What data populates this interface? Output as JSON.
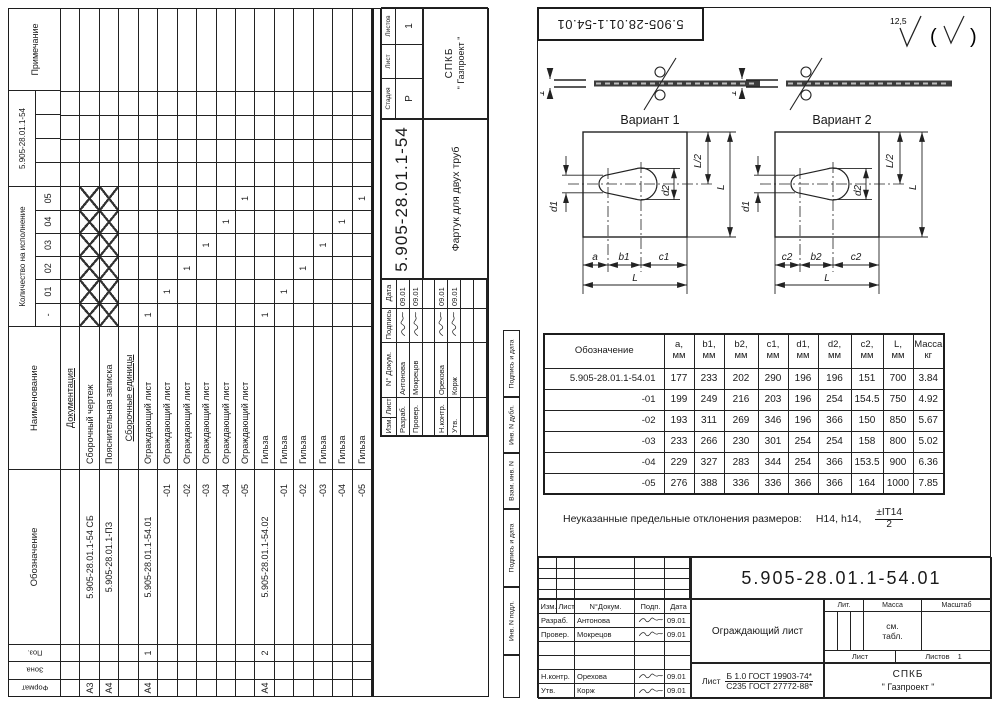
{
  "left_sheet": {
    "cols": {
      "format": "Формат",
      "zone": "Зона",
      "pos": "Поз.",
      "designation": "Обозначение",
      "name": "Наименование",
      "note": "Примечание"
    },
    "qty_group_label": "Количество на исполнение",
    "qty_group_doc": "5.905-28.01.1-54",
    "qty_cols": [
      "-",
      "01",
      "02",
      "03",
      "04",
      "05"
    ],
    "rows": [
      {
        "name": "Документация",
        "u": 1
      },
      {
        "format": "А3",
        "designation": "5.905-28.01.1-54 СБ",
        "name": "Сборочный чертеж",
        "qty": [
          "x",
          "x",
          "x",
          "x",
          "x",
          "x"
        ]
      },
      {
        "format": "А4",
        "designation": "5.905-28.01.1-ПЗ",
        "name": "Пояснительная записка",
        "qty": [
          "x",
          "x",
          "x",
          "x",
          "x",
          "x"
        ]
      },
      {
        "name": "Сборочные единицы",
        "u": 1
      },
      {
        "format": "А4",
        "pos": "1",
        "designation": "5.905-28.01.1-54.01",
        "name": "Ограждающий лист",
        "qty": [
          "1",
          "",
          "",
          "",
          "",
          ""
        ]
      },
      {
        "designation": "-01",
        "name": "Ограждающий лист",
        "qty": [
          "",
          "1",
          "",
          "",
          "",
          ""
        ]
      },
      {
        "designation": "-02",
        "name": "Ограждающий лист",
        "qty": [
          "",
          "",
          "1",
          "",
          "",
          ""
        ]
      },
      {
        "designation": "-03",
        "name": "Ограждающий лист",
        "qty": [
          "",
          "",
          "",
          "1",
          "",
          ""
        ]
      },
      {
        "designation": "-04",
        "name": "Ограждающий лист",
        "qty": [
          "",
          "",
          "",
          "",
          "1",
          ""
        ]
      },
      {
        "designation": "-05",
        "name": "Ограждающий лист",
        "qty": [
          "",
          "",
          "",
          "",
          "",
          "1"
        ]
      },
      {
        "format": "А4",
        "pos": "2",
        "designation": "5.905-28.01.1-54.02",
        "name": "Гильза",
        "qty": [
          "1",
          "",
          "",
          "",
          "",
          ""
        ]
      },
      {
        "designation": "-01",
        "name": "Гильза",
        "qty": [
          "",
          "1",
          "",
          "",
          "",
          ""
        ]
      },
      {
        "designation": "-02",
        "name": "Гильза",
        "qty": [
          "",
          "",
          "1",
          "",
          "",
          ""
        ]
      },
      {
        "designation": "-03",
        "name": "Гильза",
        "qty": [
          "",
          "",
          "",
          "1",
          "",
          ""
        ]
      },
      {
        "designation": "-04",
        "name": "Гильза",
        "qty": [
          "",
          "",
          "",
          "",
          "1",
          ""
        ]
      },
      {
        "designation": "-05",
        "name": "Гильза",
        "qty": [
          "",
          "",
          "",
          "",
          "",
          "1"
        ]
      }
    ],
    "stamp": {
      "doc_number": "5.905-28.01.1-54",
      "title": "Фартук для двух труб",
      "stage_label": "Стадия",
      "sheet_label": "Лист",
      "sheets_label": "Листов",
      "stage": "Р",
      "sheet": "",
      "sheets": "1",
      "org_line1": "СПКБ",
      "org_line2": "\" Газпроект \"",
      "head": [
        "Изм.",
        "Лист",
        "N° Докум.",
        "Подпись",
        "Дата"
      ],
      "sign_rows": [
        {
          "role": "Разраб.",
          "name": "Антонова",
          "date": "09.01"
        },
        {
          "role": "Провер.",
          "name": "Мокрецов",
          "date": "09.01"
        },
        {
          "role": "",
          "name": "",
          "date": ""
        },
        {
          "role": "Н.контр.",
          "name": "Орехова",
          "date": "09.01"
        },
        {
          "role": "Утв.",
          "name": "Корж",
          "date": "09.01"
        },
        {
          "role": "",
          "name": "",
          "date": ""
        },
        {
          "role": "",
          "name": "",
          "date": ""
        }
      ]
    }
  },
  "right_sheet": {
    "flip_label": "5.905-28.01.1-54.01",
    "roughness": "12,5",
    "variants": [
      {
        "label": "Вариант 1",
        "thickness": "1",
        "dim_bottom": [
          "a",
          "b1",
          "c1"
        ],
        "dim_total": "L",
        "dim_d1": "d1",
        "dim_d2": "d2",
        "dim_half": "L/2",
        "dim_right": "L"
      },
      {
        "label": "Вариант 2",
        "thickness": "1",
        "dim_bottom": [
          "c2",
          "b2",
          "c2"
        ],
        "dim_total": "L",
        "dim_d1": "d1",
        "dim_d2": "d2",
        "dim_half": "L/2",
        "dim_right": "L"
      }
    ],
    "dims_table": {
      "headers": [
        "Обозначение",
        "a,\nмм",
        "b1,\nмм",
        "b2,\nмм",
        "c1,\nмм",
        "d1,\nмм",
        "d2,\nмм",
        "c2,\nмм",
        "L,\nмм",
        "Масса\nкг"
      ],
      "rows": [
        [
          "5.905-28.01.1-54.01",
          "177",
          "233",
          "202",
          "290",
          "196",
          "196",
          "151",
          "700",
          "3.84"
        ],
        [
          "-01",
          "199",
          "249",
          "216",
          "203",
          "196",
          "254",
          "154.5",
          "750",
          "4.92"
        ],
        [
          "-02",
          "193",
          "311",
          "269",
          "346",
          "196",
          "366",
          "150",
          "850",
          "5.67"
        ],
        [
          "-03",
          "233",
          "266",
          "230",
          "301",
          "254",
          "254",
          "158",
          "800",
          "5.02"
        ],
        [
          "-04",
          "229",
          "327",
          "283",
          "344",
          "254",
          "366",
          "153.5",
          "900",
          "6.36"
        ],
        [
          "-05",
          "276",
          "388",
          "336",
          "336",
          "366",
          "366",
          "164",
          "1000",
          "7.85"
        ]
      ]
    },
    "note_text": "Неуказанные предельные отклонения размеров:",
    "note_tol": "H14, h14,",
    "note_frac_top": "±IT14",
    "note_frac_bottom": "2",
    "side_strip": [
      "Подпись и дата",
      "Инв. N дубл.",
      "Взам. инв. N",
      "Подпись и дата",
      "Инв. N подл."
    ],
    "stamp": {
      "doc_number": "5.905-28.01.1-54.01",
      "title": "Ограждающий лист",
      "material_word": "Лист",
      "material_top": "Б 1.0 ГОСТ 19903-74*",
      "material_bottom": "С235 ГОСТ 27772-88*",
      "lit_label": "Лит.",
      "mass_label": "Масса",
      "scale_label": "Масштаб",
      "mass_value": "см.\nтабл.",
      "sheet_label": "Лист",
      "sheets_label": "Листов",
      "sheets_value": "1",
      "org_line1": "СПКБ",
      "org_line2": "\" Газпроект \"",
      "head": [
        "Изм.",
        "Лист",
        "N°Докум.",
        "Подп.",
        "Дата"
      ],
      "sign_rows": [
        {
          "role": "Разраб.",
          "name": "Антонова",
          "date": "09.01"
        },
        {
          "role": "Провер.",
          "name": "Мокрецов",
          "date": "09.01"
        },
        {
          "role": "",
          "name": "",
          "date": ""
        },
        {
          "role": "",
          "name": "",
          "date": ""
        },
        {
          "role": "Н.контр.",
          "name": "Орехова",
          "date": "09.01"
        },
        {
          "role": "Утв.",
          "name": "Корж",
          "date": "09.01"
        }
      ]
    }
  }
}
